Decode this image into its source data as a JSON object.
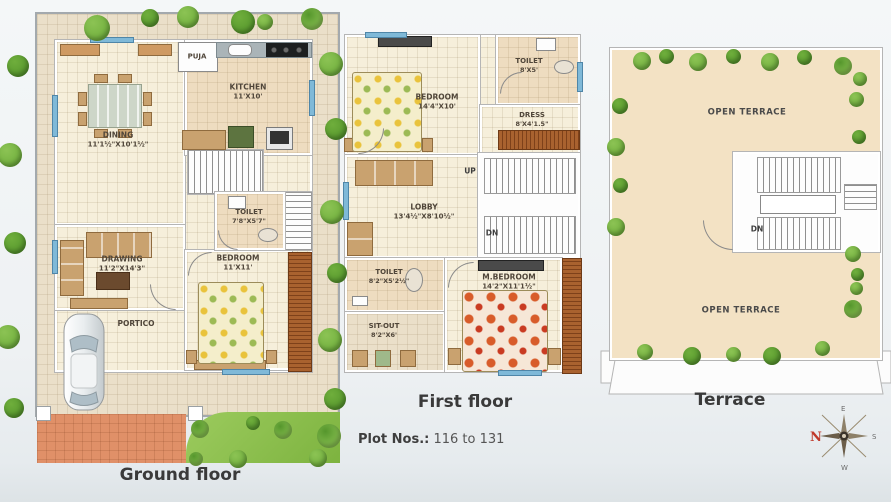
{
  "plot_info": {
    "label": "Plot Nos.:",
    "value": "116 to 131"
  },
  "floors": {
    "ground": {
      "title": "Ground floor",
      "rooms": {
        "dining": {
          "name": "DINING",
          "dims": "11'1½\"X10'1½\""
        },
        "kitchen": {
          "name": "KITCHEN",
          "dims": "11'X10'"
        },
        "puja": {
          "name": "PUJA"
        },
        "toilet": {
          "name": "TOILET",
          "dims": "7'8\"X5'7\""
        },
        "drawing": {
          "name": "DRAWING",
          "dims": "11'2\"X14'3\""
        },
        "bedroom": {
          "name": "BEDROOM",
          "dims": "11'X11'"
        },
        "portico": {
          "name": "PORTICO"
        }
      }
    },
    "first": {
      "title": "First floor",
      "rooms": {
        "bedroom": {
          "name": "BEDROOM",
          "dims": "14'4\"X10'"
        },
        "toilet_top": {
          "name": "TOILET",
          "dims": "8'X5'"
        },
        "dress": {
          "name": "DRESS",
          "dims": "8'X4'1.5\""
        },
        "lobby": {
          "name": "LOBBY",
          "dims": "13'4½\"X8'10½\""
        },
        "toilet_bottom": {
          "name": "TOILET",
          "dims": "8'2\"X5'2½\""
        },
        "sitout": {
          "name": "SIT-OUT",
          "dims": "8'2\"X6'"
        },
        "master_bedroom": {
          "name": "M.BEDROOM",
          "dims": "14'2\"X11'1½\""
        }
      },
      "stairs": {
        "up": "UP",
        "down": "DN"
      }
    },
    "terrace": {
      "title": "Terrace",
      "areas": {
        "open_terrace_top": "OPEN TERRACE",
        "open_terrace_bottom": "OPEN TERRACE"
      },
      "stairs": {
        "down": "DN"
      }
    }
  },
  "compass": {
    "north": "N",
    "east": "E",
    "south": "S",
    "west": "W"
  },
  "colors": {
    "lawn_green": "#8CC152",
    "driveway_terracotta": "#E09068",
    "floor_cream": "#F6EFDB",
    "plot_tile": "#EADFC9",
    "wet_floor": "#EEDCC0",
    "deck_brown": "#A9622F",
    "window_blue": "#7FB9D8",
    "compass_north_red": "#C0392B",
    "tree_green": "#79B43E",
    "title_text": "#3A3A3A",
    "label_text": "#50463A"
  }
}
